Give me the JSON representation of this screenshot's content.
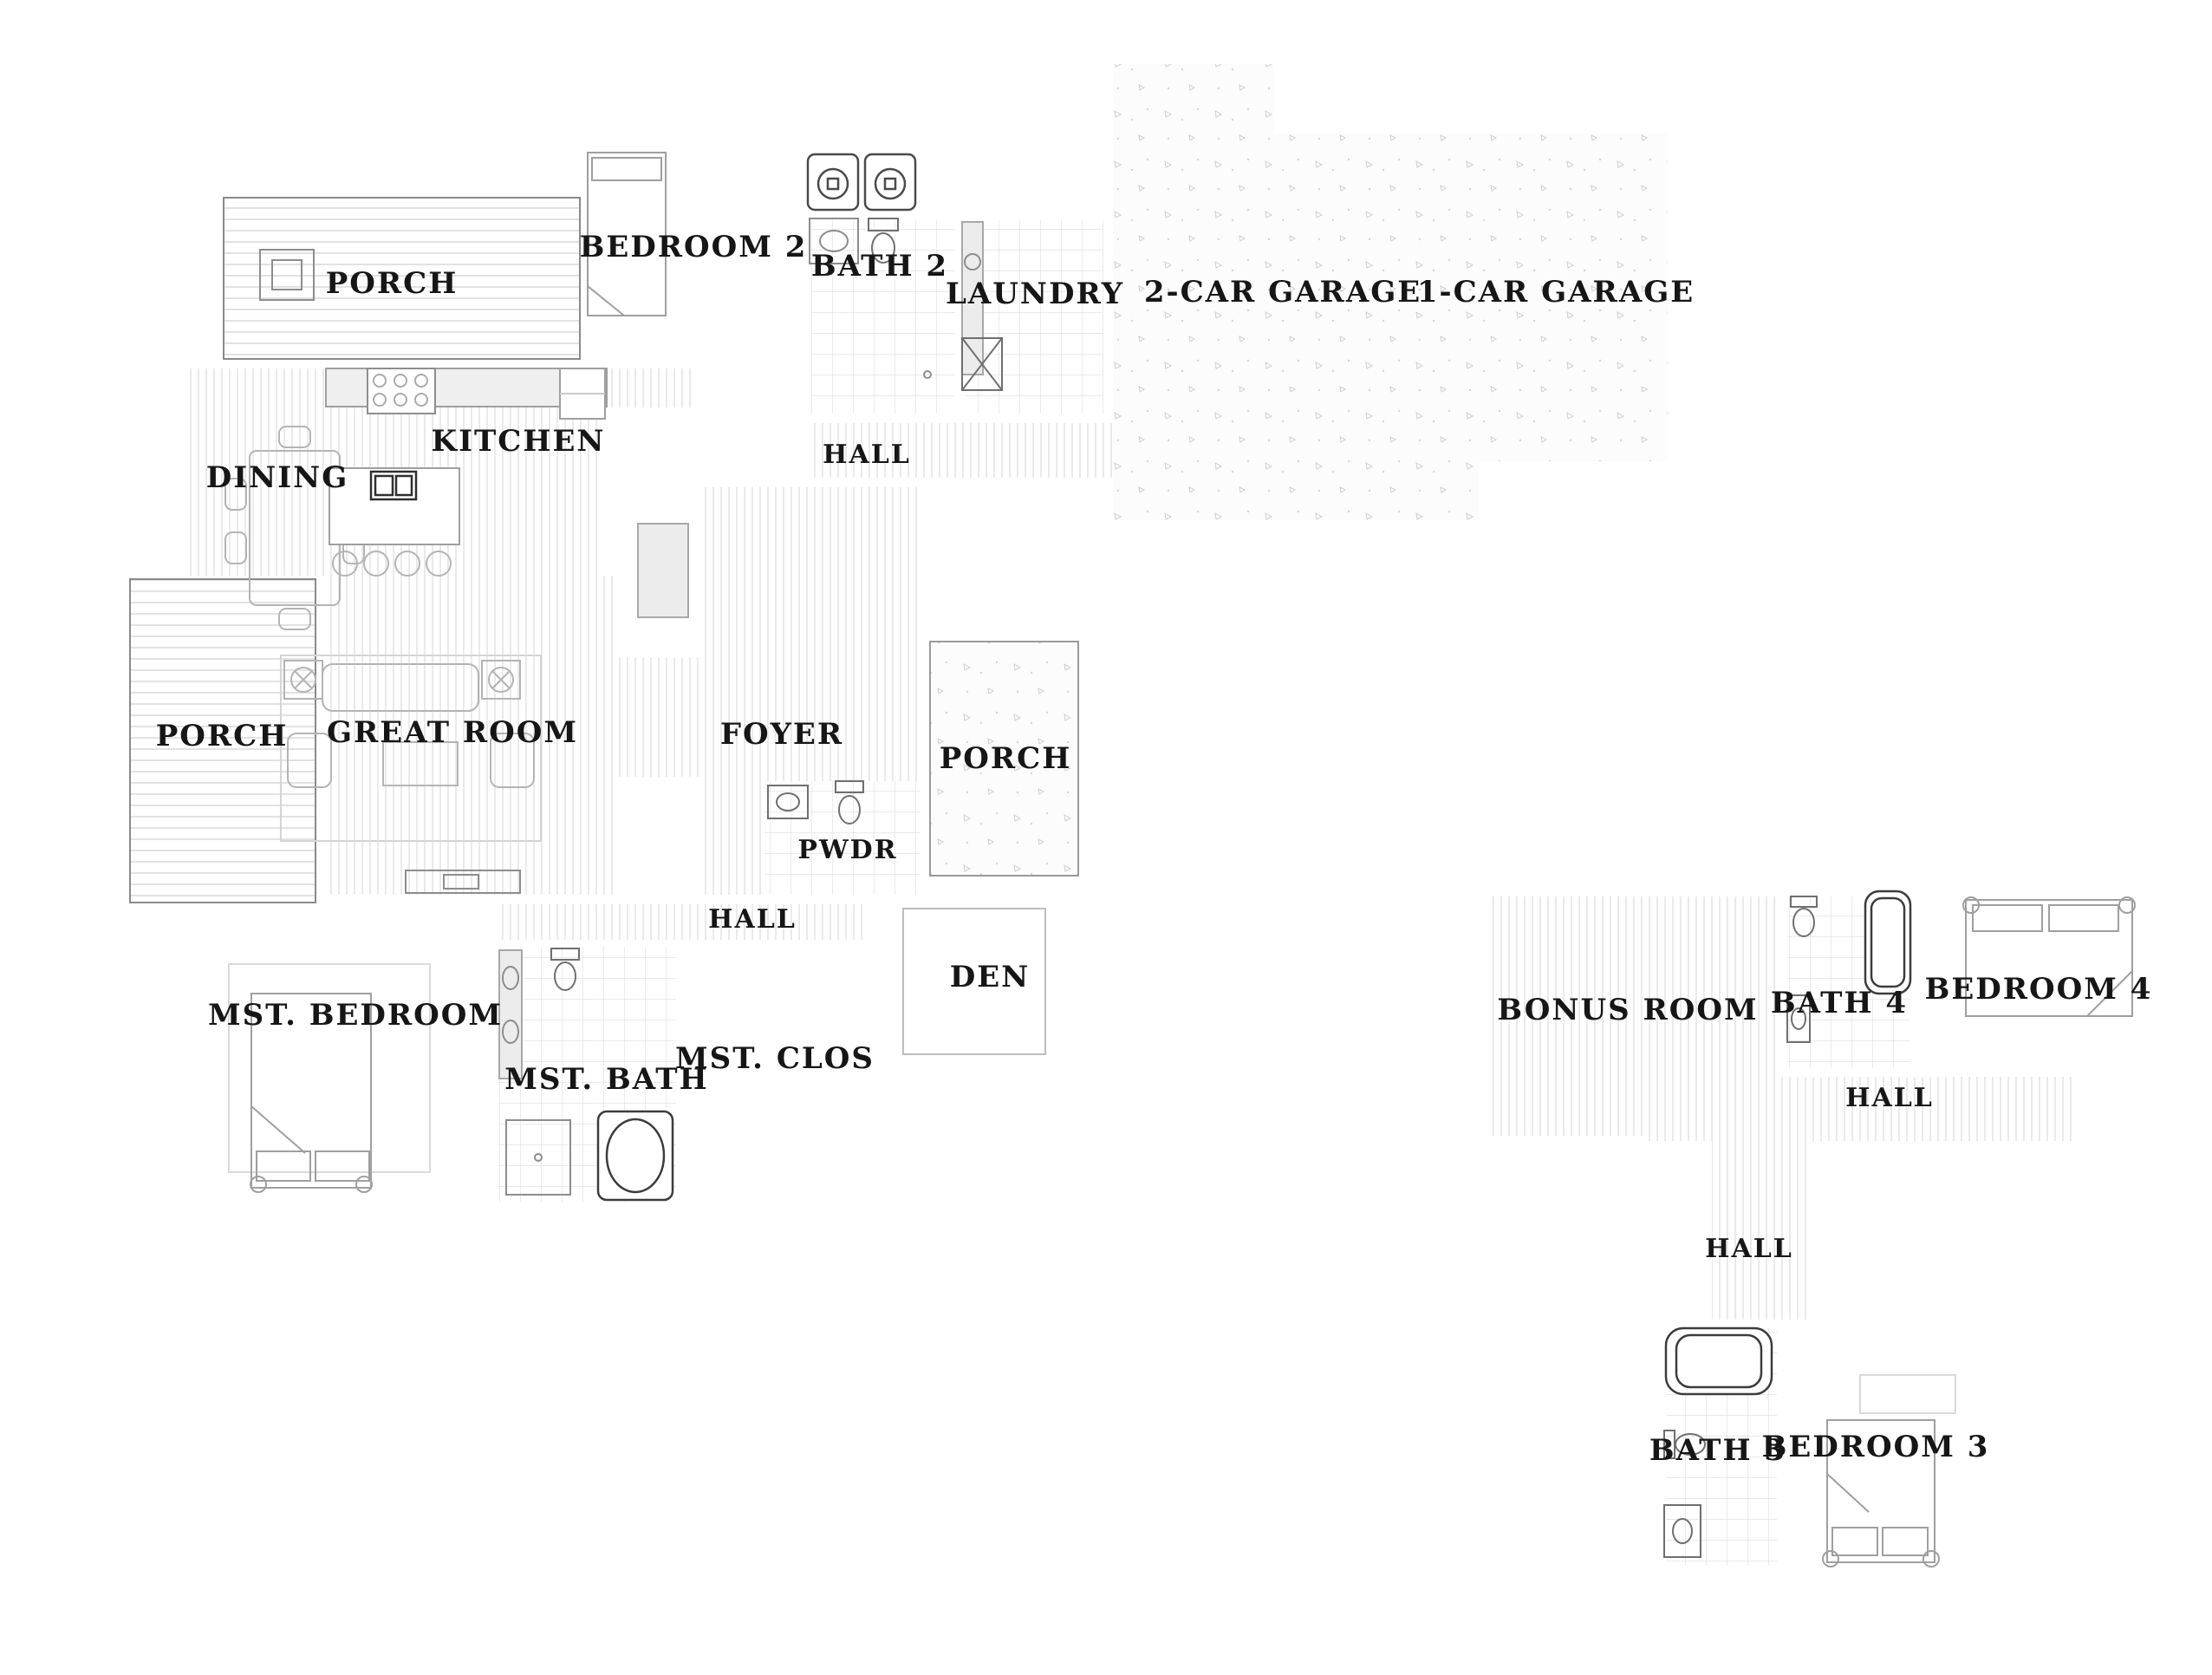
{
  "drawing": {
    "type": "residential-floor-plan",
    "floors_shown": 2
  },
  "palette": {
    "background": "#ffffff",
    "wall_fill": "#b5b5b5",
    "wall_line": "#2d2d2d",
    "label_text": "#161616",
    "floor_hatch": "#d9d9d9",
    "dash_line": "#3f3f3f",
    "furniture_line": "#b4b4b4"
  },
  "rooms": {
    "porch_upper": "PORCH",
    "bedroom2": "BEDROOM 2",
    "bath2": "BATH 2",
    "laundry": "LAUNDRY",
    "garage2": "2-CAR GARAGE",
    "garage1": "1-CAR GARAGE",
    "kitchen": "KITCHEN",
    "dining": "DINING",
    "hall_upper": "HALL",
    "porch_left": "PORCH",
    "great_room": "GREAT ROOM",
    "foyer": "FOYER",
    "porch_front": "PORCH",
    "pwdr": "PWDR",
    "hall_main": "HALL",
    "den": "DEN",
    "mst_bedroom": "MST. BEDROOM",
    "mst_bath": "MST. BATH",
    "mst_clos": "MST. CLOS",
    "bonus_room": "BONUS ROOM",
    "bath4": "BATH 4",
    "bedroom4": "BEDROOM 4",
    "hall_floor2": "HALL",
    "hall_stairs2": "HALL",
    "bath3": "BATH 3",
    "bedroom3": "BEDROOM 3"
  },
  "fixtures": [
    "car-icon",
    "pickup-truck-icon",
    "bed-icon",
    "bathtub-icon",
    "toilet-icon",
    "sink-icon",
    "shower-icon",
    "washer-icon",
    "dryer-icon",
    "range-icon",
    "kitchen-island-icon",
    "dining-table-icon",
    "sofa-icon",
    "stairs-icon",
    "closet-hangers-icon",
    "porch-post-icon"
  ]
}
